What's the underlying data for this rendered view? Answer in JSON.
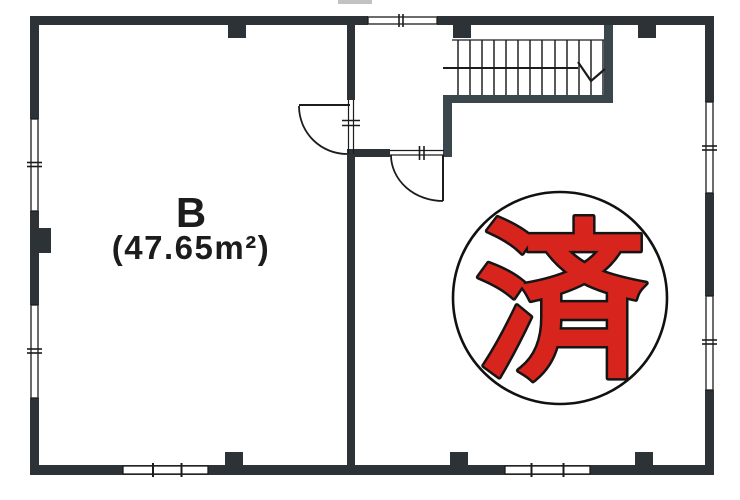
{
  "floor_plan": {
    "room_b": {
      "label": "B",
      "area": "(47.65m²)"
    },
    "stamp": {
      "kanji": "済"
    },
    "stairs": {
      "tread_count": 13
    },
    "colors": {
      "wall": "#2c3236",
      "stair_wall": "#39464b",
      "line": "#1c1c1c",
      "stamp_red": "#d7241c",
      "paper": "#ffffff"
    }
  }
}
